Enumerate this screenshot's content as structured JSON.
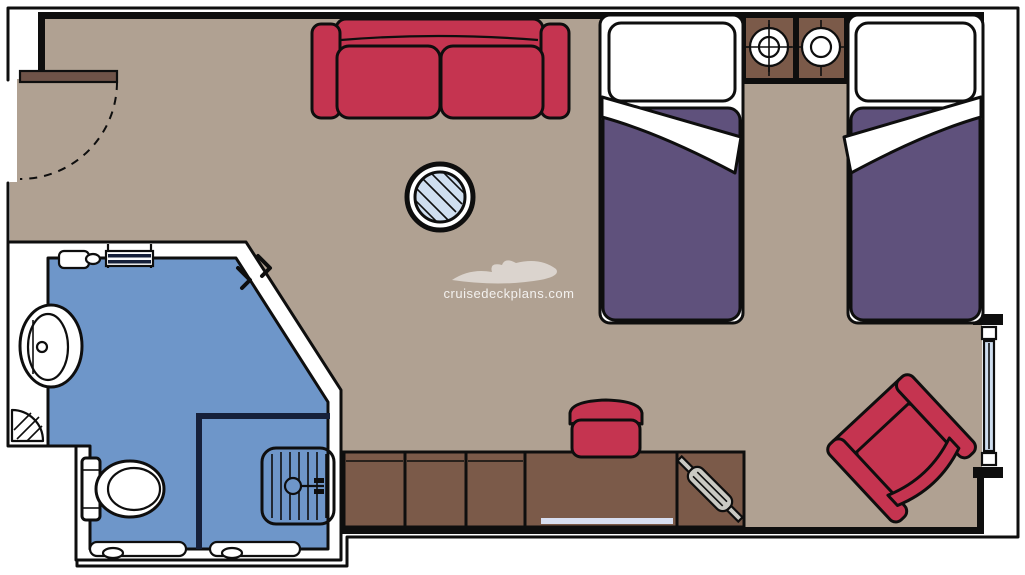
{
  "watermark": {
    "text": "cruisedeckplans.com",
    "logo_icon": "cruise-ship-silhouette"
  },
  "colors": {
    "floor": "#b0a192",
    "bath": "#6e96c9",
    "line": "#0e0e0e",
    "red": "#c53450",
    "purple": "#5f517c",
    "brown": "#7b5a49",
    "door": "#6f5348",
    "glass": "#cfdeef",
    "navy": "#16203a",
    "metal": "#c9c9c3",
    "strip": "#d8def0"
  },
  "plan_elements": [
    "entry-door-with-swing-arc",
    "two-seat-sofa",
    "round-glass-table",
    "twin-bed-left",
    "twin-bed-right",
    "nightstand-with-lamp-left",
    "nightstand-with-lamp-right",
    "balcony-window",
    "bathroom",
    "washbasin",
    "toilet",
    "shower-stall",
    "towel-rack",
    "corner-shelf",
    "desk-console-cabinets",
    "stool",
    "hairdryer",
    "armchair"
  ]
}
